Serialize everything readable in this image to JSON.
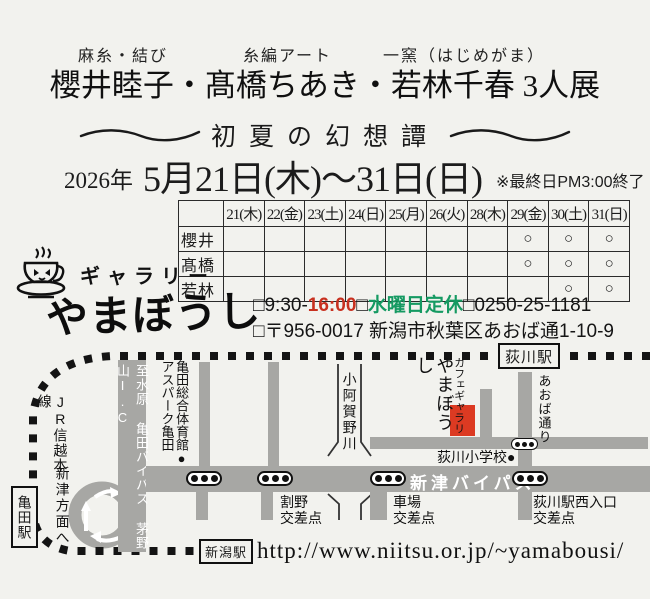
{
  "colors": {
    "accent_red": "#c8301f",
    "accent_green": "#159a62",
    "marker_red": "#dc3a22",
    "road_gray": "#a7a7a4",
    "ink": "#1c1c1c"
  },
  "header": {
    "roles": [
      {
        "label": "麻糸・結び"
      },
      {
        "label": "糸編アート"
      },
      {
        "label": "一窯（はじめがま）"
      }
    ],
    "title": "櫻井睦子・髙橋ちあき・若林千春 3人展",
    "subtitle": "初夏の幻想譚",
    "date_year": "2026年",
    "date_range": "5月21日(木)～31日(日)",
    "date_note": "※最終日PM3:00終了"
  },
  "schedule": {
    "columns": [
      "21(木)",
      "22(金)",
      "23(土)",
      "24(日)",
      "25(月)",
      "26(火)",
      "28(木)",
      "29(金)",
      "30(土)",
      "31(日)"
    ],
    "rows": [
      {
        "name": "櫻井",
        "marks": [
          "",
          "",
          "",
          "",
          "",
          "",
          "",
          "○",
          "○",
          "○"
        ]
      },
      {
        "name": "髙橋",
        "marks": [
          "",
          "",
          "",
          "",
          "",
          "",
          "",
          "○",
          "○",
          "○"
        ]
      },
      {
        "name": "若林",
        "marks": [
          "",
          "",
          "",
          "",
          "",
          "",
          "",
          "",
          "○",
          "○"
        ]
      }
    ]
  },
  "gallery": {
    "type_label": "ギャラリー",
    "name": "やまぼうし",
    "hours_prefix": "□9:30-",
    "hours_close": "16:00",
    "closed_prefix": "□",
    "closed_label": "水曜日定休",
    "phone_prefix": "□",
    "phone": "0250-25-1181",
    "address": "□〒956-0017 新潟市秋葉区あおば通1-10-9"
  },
  "map": {
    "rail_name": "JR信越本線",
    "stations": {
      "ogikawa": "荻川駅",
      "kameda": "亀田駅",
      "niigata": "新潟駅"
    },
    "road_kameda_bypass": "至水原 亀田バイパス 茅野山I.C",
    "road_niitsu_bypass": "新津バイパス",
    "road_aoba": "あおば通り",
    "river": "小阿賀野川",
    "gym": "亀田総合体育館●\nアスパーク亀田",
    "cafe_small": "カフェギャラリー",
    "cafe_big": "やまぼうし",
    "school": "荻川小学校●",
    "to_niitsu": "新津方面へ",
    "ix_warino": "割野\n交差点",
    "ix_shaba": "車場\n交差点",
    "ix_ogikawa_west": "荻川駅西入口\n交差点",
    "url": "http://www.niitsu.or.jp/~yamabousi/"
  }
}
